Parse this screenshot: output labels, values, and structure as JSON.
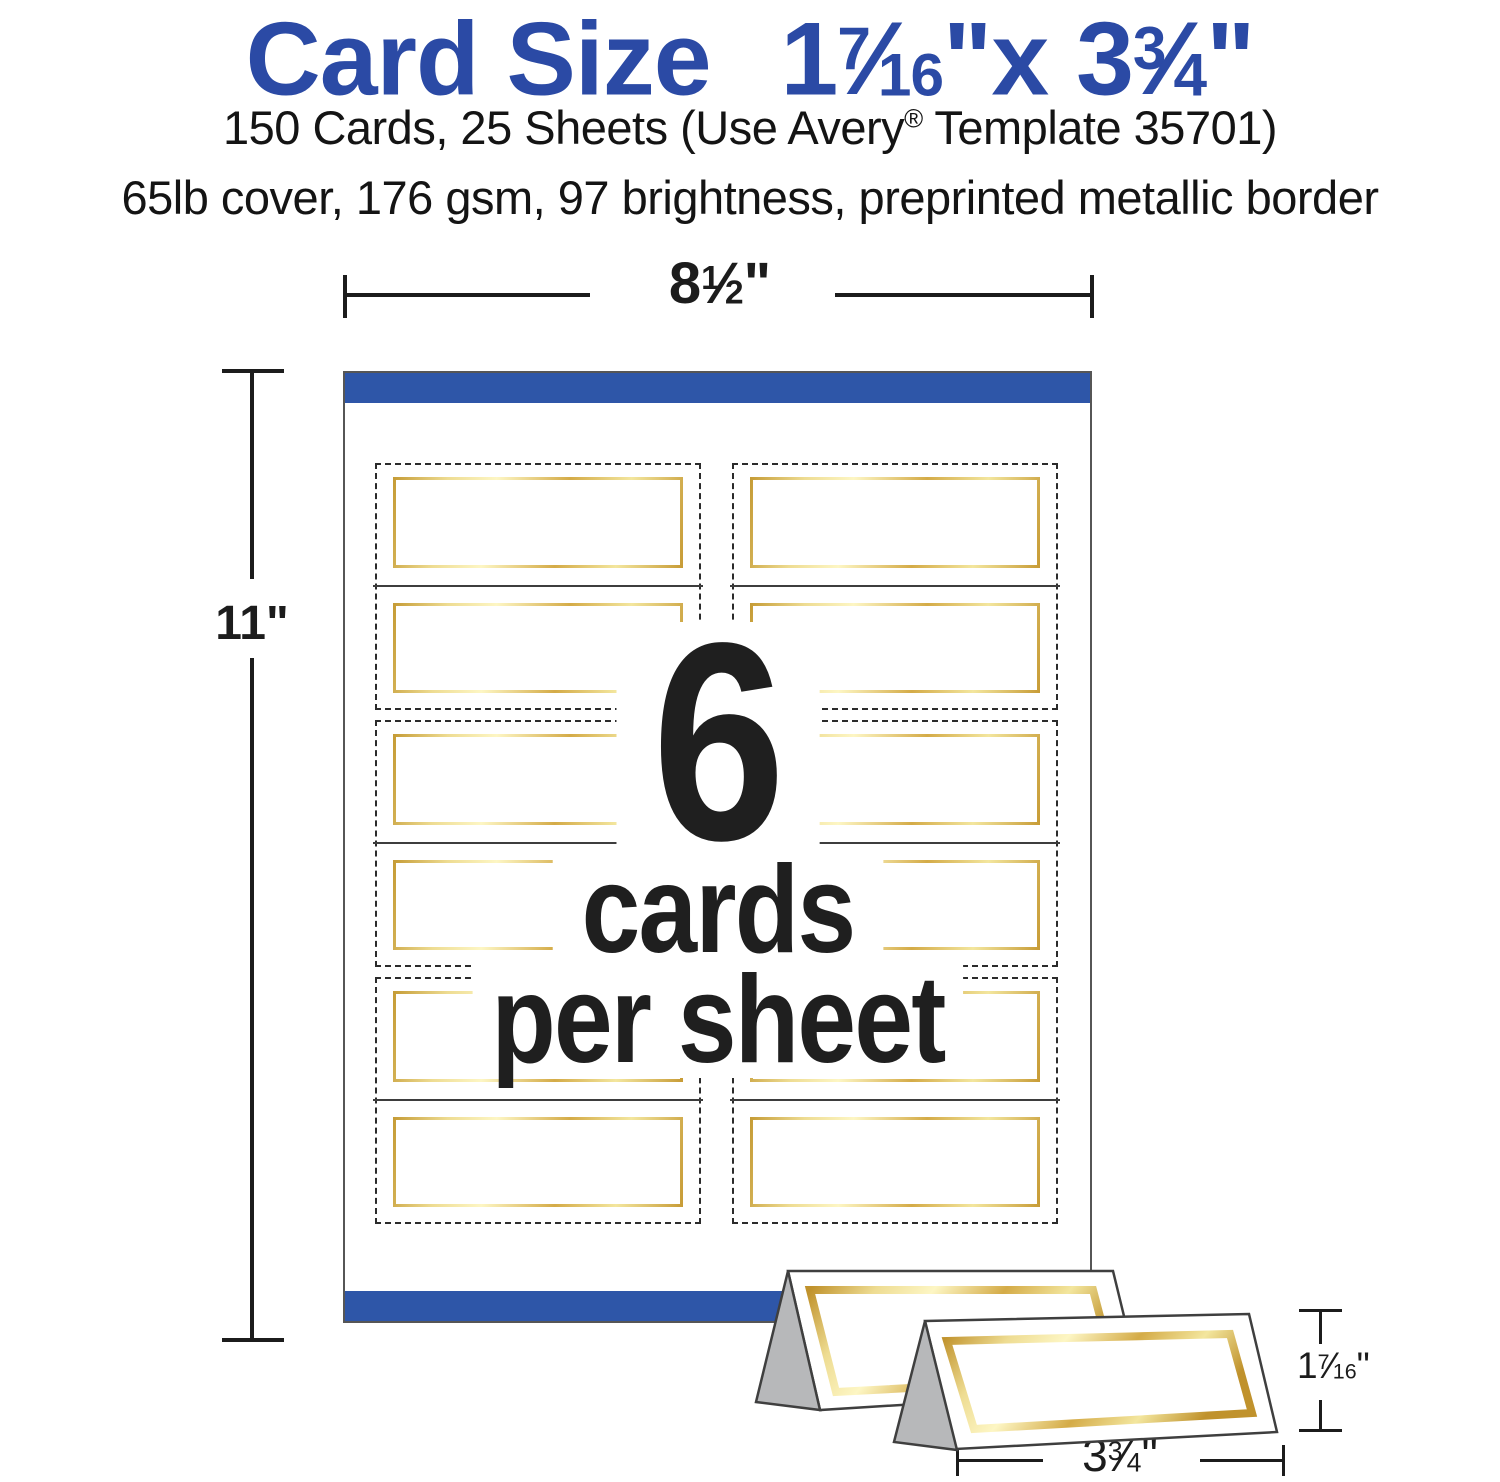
{
  "header": {
    "title": {
      "label": "Card Size",
      "w1": "1",
      "f1n": "7",
      "f1d": "16",
      "sep": "x",
      "w2": "3",
      "f2n": "3",
      "f2d": "4",
      "inch": "\""
    },
    "line1": {
      "pre": "150 Cards, 25 Sheets (Use Avery",
      "reg": "®",
      "post": " Template 35701)"
    },
    "line2": "65lb cover, 176 gsm, 97 brightness, preprinted metallic border"
  },
  "dims": {
    "sheet_width": {
      "whole": "8",
      "num": "1",
      "den": "2",
      "inch": "\""
    },
    "sheet_height": "11\"",
    "card_height": {
      "whole": "1",
      "num": "7",
      "den": "16",
      "inch": "\""
    },
    "card_width": {
      "whole": "3",
      "num": "3",
      "den": "4",
      "inch": "\""
    }
  },
  "sheet_center": {
    "count": "6",
    "line2": "cards",
    "line3": "per sheet"
  },
  "sheet": {
    "cards_per_sheet": 6,
    "columns": 2,
    "rows": 3
  },
  "colors": {
    "title_blue": "#2b4aa5",
    "band_blue": "#2e56a8",
    "gold_dark": "#c59b35",
    "gold_light": "#fdf6c4",
    "tent_side_gray": "#b7b8ba",
    "text_dark": "#1f1f1f"
  }
}
